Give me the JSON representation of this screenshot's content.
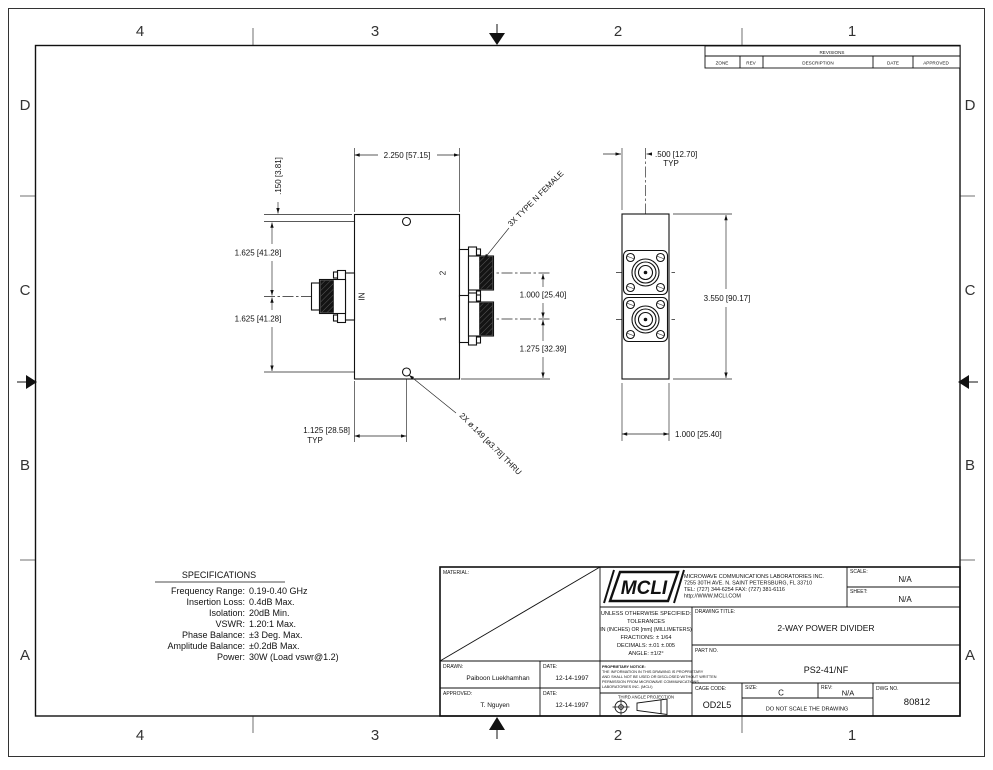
{
  "sheet": {
    "zones_h": [
      "4",
      "3",
      "2",
      "1"
    ],
    "zones_v": [
      "D",
      "C",
      "B",
      "A"
    ]
  },
  "revisions": {
    "title": "REVISIONS",
    "columns": [
      "ZONE",
      "REV",
      "DESCRIPTION",
      "DATE",
      "APPROVED"
    ]
  },
  "specifications": {
    "title": "SPECIFICATIONS",
    "items": [
      {
        "label": "Frequency Range:",
        "value": "0.19-0.40 GHz"
      },
      {
        "label": "Insertion Loss:",
        "value": "0.4dB Max."
      },
      {
        "label": "Isolation:",
        "value": "20dB Min."
      },
      {
        "label": "VSWR:",
        "value": "1.20:1 Max."
      },
      {
        "label": "Phase Balance:",
        "value": "±3 Deg. Max."
      },
      {
        "label": "Amplitude Balance:",
        "value": "±0.2dB Max."
      },
      {
        "label": "Power:",
        "value": "30W (Load vswr@1.2)"
      }
    ]
  },
  "front_view": {
    "dim_width": "2.250 [57.15]",
    "dim_hole_top": ".150 [3.81]",
    "dim_upper": "1.625 [41.28]",
    "dim_lower": "1.625 [41.28]",
    "dim_ports": "1.000 [25.40]",
    "dim_port1": "1.275 [32.39]",
    "dim_hole_x": "1.125 [28.58]",
    "typ": "TYP",
    "note_holes": "2X ø.149 [ø3.78] THRU",
    "note_connectors": "3X TYPE N FEMALE",
    "label_in": "IN",
    "label_port2": "2",
    "label_port1": "1"
  },
  "side_view": {
    "dim_offset": ".500 [12.70]",
    "typ": "TYP",
    "dim_height": "3.550 [90.17]",
    "dim_width": "1.000 [25.40]"
  },
  "title_block": {
    "material_label": "MATERIAL:",
    "logo": "MCLI",
    "company_name": "MICROWAVE COMMUNICATIONS LABORATORIES INC.",
    "company_address": "7255 30TH AVE. N. SAINT PETERSBURG, FL 33710",
    "company_phone": "TEL: (727) 344-6254   FAX: (727) 381-6116",
    "company_url": "http://WWW.MCLI.COM",
    "scale_label": "SCALE:",
    "scale_value": "N/A",
    "sheet_label": "SHEET:",
    "sheet_value": "N/A",
    "tol_line1": "UNLESS OTHERWISE SPECIFIED:",
    "tol_line2": "TOLERANCES",
    "tol_line3": "IN (INCHES) OR [mm] (MILLIMETERS)",
    "tol_line4": "FRACTIONS: ± 1/64",
    "tol_line5": "DECIMALS: ±.01 ±.005",
    "tol_line6": "ANGLE: ±1/2°",
    "drawing_title_label": "DRAWING TITLE:",
    "drawing_title": "2-WAY POWER DIVIDER",
    "part_no_label": "PART NO.",
    "part_no": "PS2-41/NF",
    "drawn_label": "DRAWN:",
    "drawn_name": "Paiboon Luekhamhan",
    "drawn_date_label": "DATE:",
    "drawn_date": "12-14-1997",
    "approved_label": "APPROVED:",
    "approved_name": "T. Nguyen",
    "approved_date_label": "DATE:",
    "approved_date": "12-14-1997",
    "prop_line1": "PROPRIETARY NOTICE:",
    "prop_line2": "THE INFORMATION IN THIS DRAWING IS PROPRIETARY",
    "prop_line3": "AND SHALL NOT BE USED OR DISCLOSED WITHOUT WRITTEN",
    "prop_line4": "PERMISSION FROM MICROWAVE COMMUNICATIONS",
    "prop_line5": "LABORATORIES INC. (MCLI)",
    "projection_label": "THIRD ANGLE PROJECTION",
    "cage_code_label": "CAGE CODE:",
    "cage_code": "OD2L5",
    "size_label": "SIZE:",
    "size_value": "C",
    "rev_label": "REV:",
    "rev_value": "N/A",
    "no_scale_note": "DO NOT SCALE THE DRAWING",
    "dwg_no_label": "DWG NO.",
    "dwg_no": "80812"
  }
}
